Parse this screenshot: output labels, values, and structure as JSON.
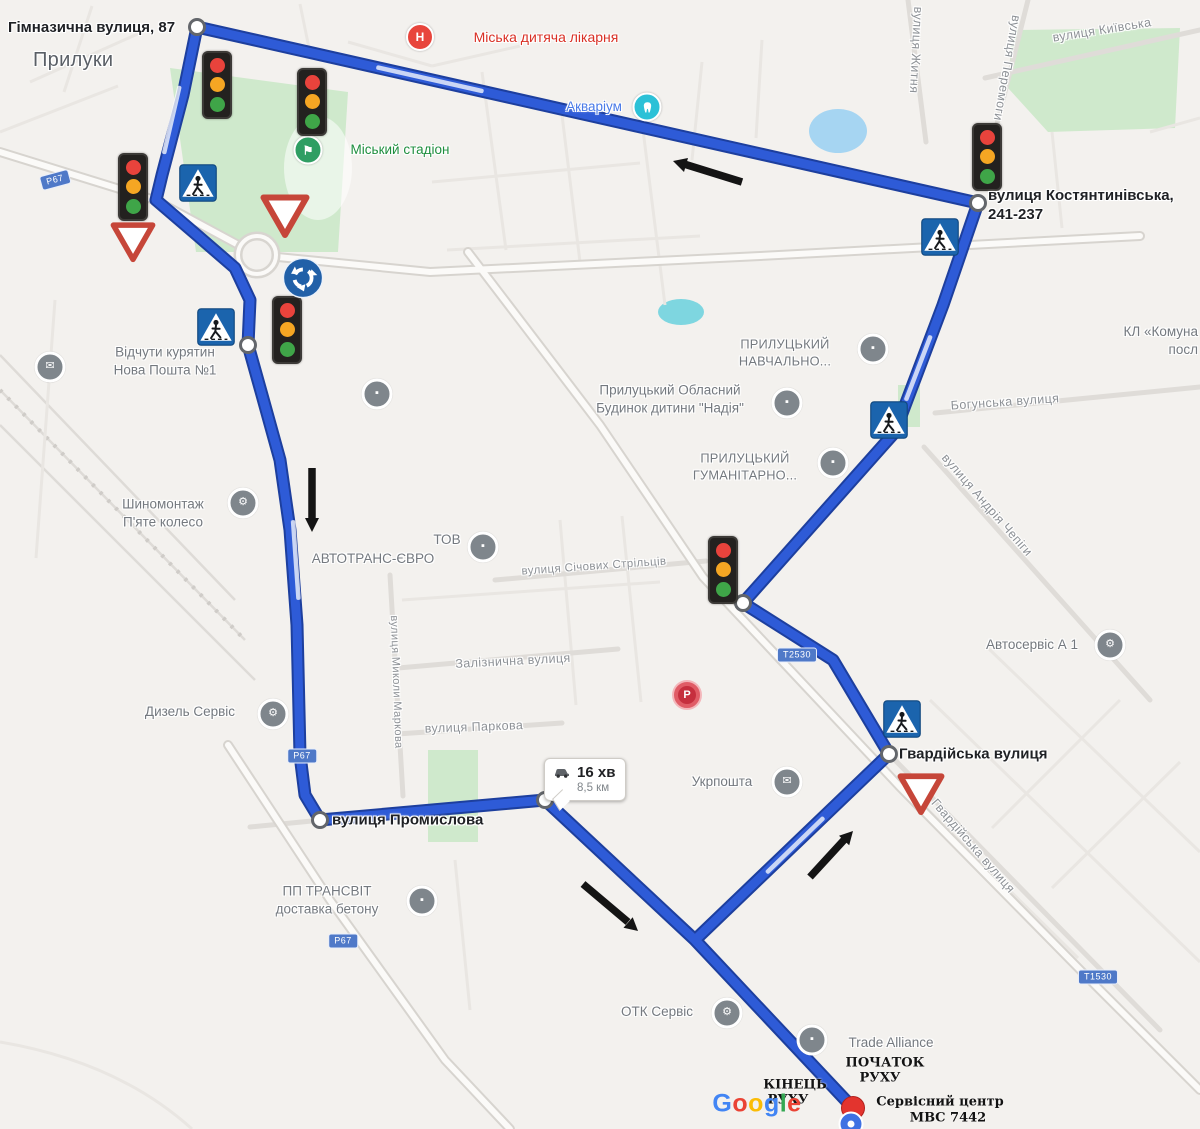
{
  "city": "Прилуки",
  "badge": {
    "duration": "16 хв",
    "distance": "8,5 км"
  },
  "addresses": {
    "gimnazychna": "Гімназична вулиця, 87",
    "kost1": "вулиця Костянтинівська,",
    "kost2": "241-237",
    "hvardiiska": "Гвардійська вулиця",
    "promyslova": "вулиця Промислова"
  },
  "pois": {
    "hospital": "Міська дитяча лікарня",
    "aquarium": "Акваріум",
    "stadium": "Міський стадіон",
    "nova1": "Відчути курятин",
    "nova2": "Нова Пошта №1",
    "shyno1": "Шиномонтаж",
    "shyno2": "П'яте колесо",
    "avtotrans1": "ТОВ",
    "avtotrans2": "АВТОТРАНС-ЄВРО",
    "oblasnyi1": "Прилуцький Обласний",
    "oblasnyi2": "Будинок дитини \"Надія\"",
    "navch1": "ПРИЛУЦЬКИЙ",
    "navch2": "НАВЧАЛЬНО...",
    "human1": "ПРИЛУЦЬКИЙ",
    "human2": "ГУМАНІТАРНО...",
    "komuna1": "КЛ «Комуна",
    "komuna2": "посл",
    "dyzel": "Дизель Сервіс",
    "avtoservis": "Автосервіс А 1",
    "ukrposhta": "Укрпошта",
    "transvit1": "ПП ТРАНСВІТ",
    "transvit2": "доставка бетону",
    "otk": "ОТК Сервіс",
    "trade": "Trade Alliance"
  },
  "streets": {
    "kyivska": "вулиця Київська",
    "peremohy": "вулиця Перемоги",
    "zhytnia": "вулиця Житня",
    "bohunska": "Богунська вулиця",
    "chepihy": "вулиця Андрія Чепіги",
    "sichovykh": "вулиця Січових Стрільців",
    "zaliznychna": "Залізнична вулиця",
    "parkova": "вулиця Паркова",
    "markova": "вулиця Миколи Маркова",
    "hvardiiska_diag": "Гвардійська вулиця"
  },
  "shields": {
    "p67": "Р67",
    "t2530": "Т2530",
    "t1530": "Т1530"
  },
  "endpoints": {
    "start1": "ПОЧАТОК",
    "start2": "РУХУ",
    "end1": "КІНЕЦЬ",
    "end2": "РУХУ",
    "dest1": "Сервісний центр",
    "dest2": "МВС 7442"
  },
  "google": [
    "G",
    "o",
    "o",
    "g",
    "l",
    "e"
  ],
  "icons": {
    "post": "✉",
    "service": "⚙",
    "generic": "▪",
    "hospital_letter": "Н",
    "parking_letter": "Р",
    "stadium_flag": "⚑"
  },
  "colors": {
    "route": "#2e5bd7",
    "route_casing": "#1d3f9e",
    "park": "#cfe9cc",
    "water": "#a6d5f2",
    "pond": "#7ed6e0",
    "poi_gray": "#7f868c",
    "accent_red": "#d93025",
    "accent_blue": "#4a7be8",
    "accent_green": "#1e8e3e"
  }
}
